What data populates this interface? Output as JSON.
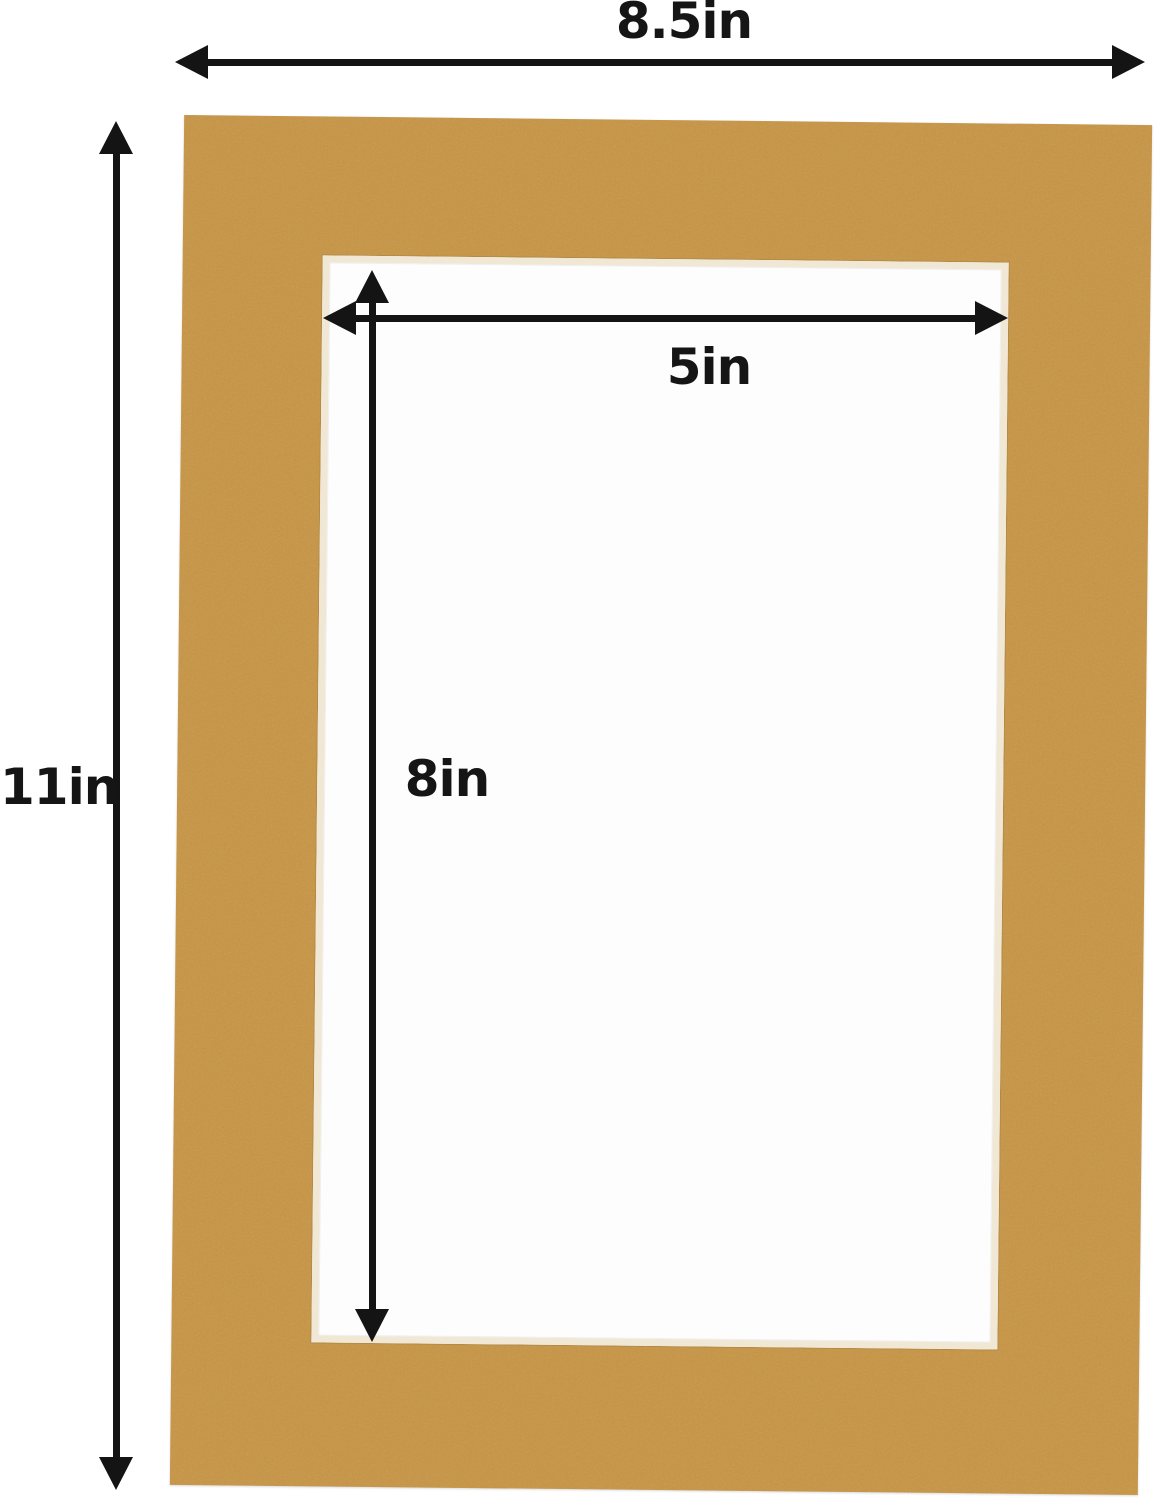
{
  "figure": {
    "type": "mat-board-dimension-diagram",
    "labels": {
      "outer_width": "8.5in",
      "outer_height": "11in",
      "opening_width": "5in",
      "opening_height": "8in"
    },
    "dimensions_in": {
      "outer_width": 8.5,
      "outer_height": 11,
      "opening_width": 5,
      "opening_height": 8
    },
    "colors": {
      "mat": "#c79442",
      "bevel": "#f0e8d5",
      "opening": "#fdfdfd",
      "arrow": "#141414",
      "background": "#ffffff"
    }
  }
}
